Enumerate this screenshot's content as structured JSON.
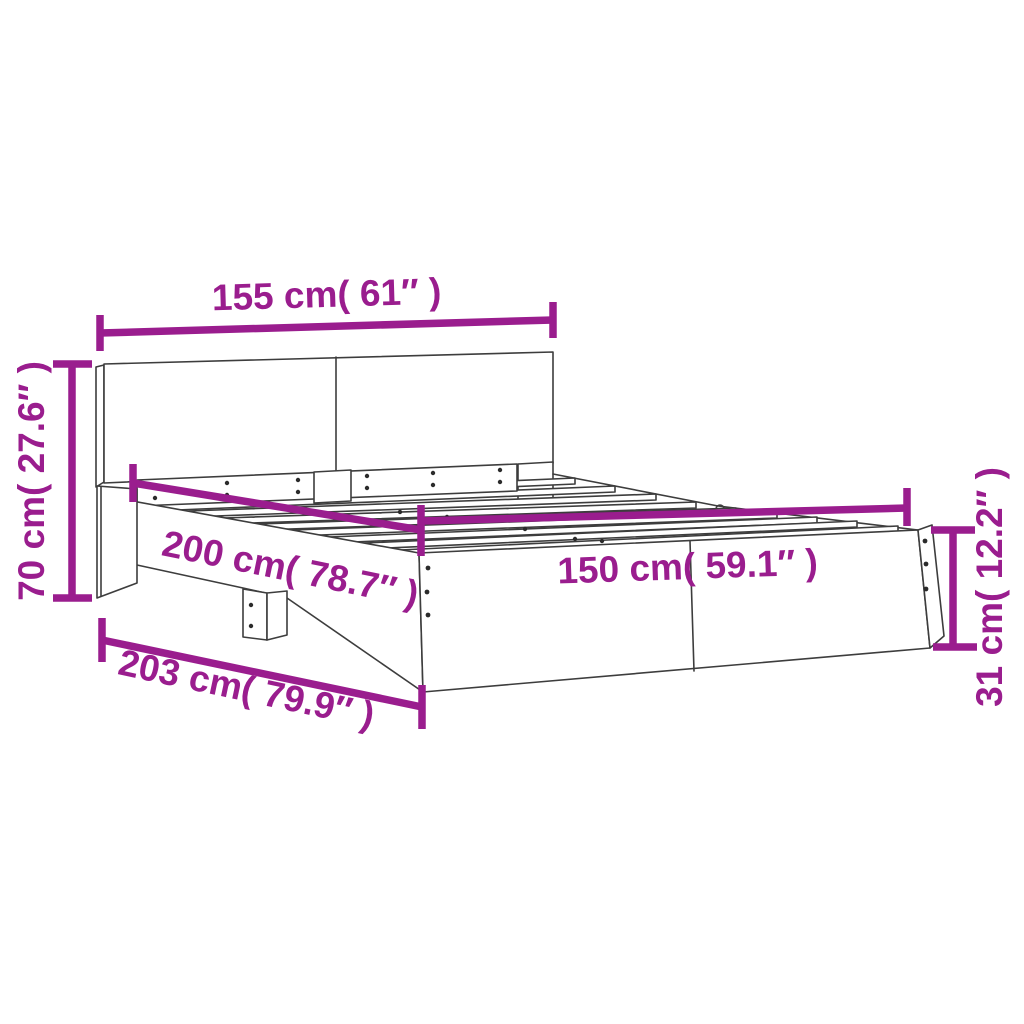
{
  "diagram": {
    "type": "product-dimension-diagram",
    "product": "bed-frame-with-headboard",
    "colors": {
      "dimension_accent": "#9A1D8E",
      "line_art": "#3D3D3D",
      "background": "#FFFFFF"
    },
    "dimensions": {
      "headboard_width": {
        "label": "155 cm( 61″ )"
      },
      "headboard_height": {
        "label": "70 cm( 27.6″ )"
      },
      "frame_length": {
        "label": "200 cm( 78.7″ )"
      },
      "frame_width": {
        "label": "150 cm( 59.1″ )"
      },
      "total_length": {
        "label": "203 cm( 79.9″ )"
      },
      "footboard_height": {
        "label": "31 cm( 12.2″ )"
      }
    }
  }
}
